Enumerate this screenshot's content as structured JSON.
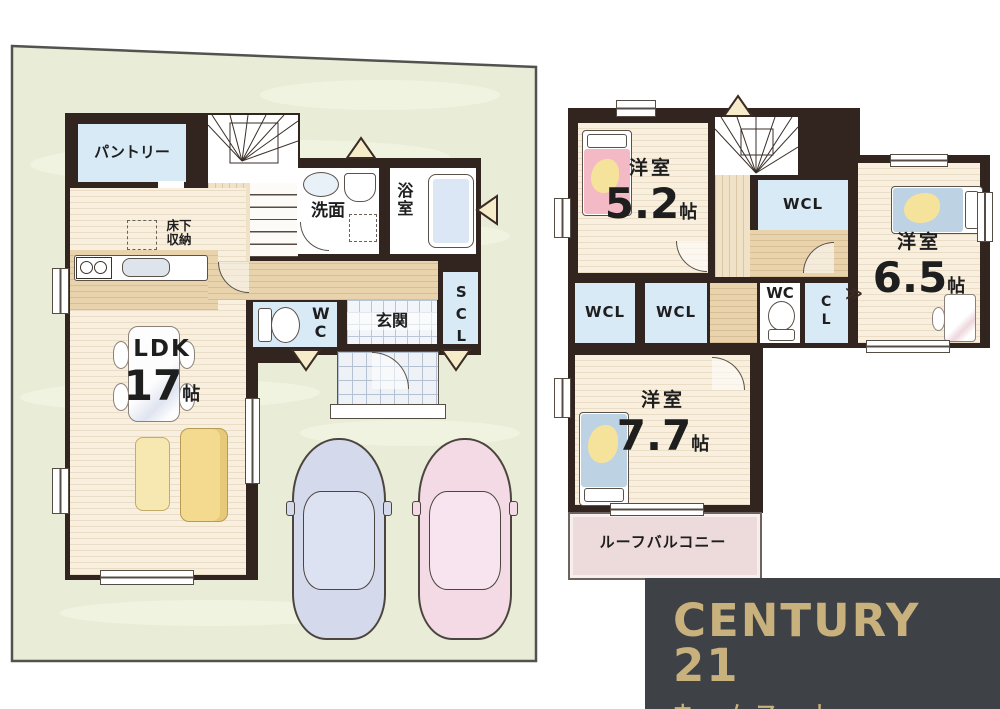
{
  "floor1": {
    "pantry": "パントリー",
    "washroom": "洗面",
    "bathroom": "浴室",
    "toilet": "WC",
    "entrance": "玄関",
    "shoe_closet": "SCL",
    "underfloor_storage_line1": "床下",
    "underfloor_storage_line2": "収納",
    "ldk": {
      "name": "LDK",
      "size": "17",
      "unit": "帖"
    }
  },
  "floor2": {
    "bedroom_5_2": {
      "name": "洋室",
      "size": "5.2",
      "unit": "帖"
    },
    "bedroom_6_5": {
      "name": "洋室",
      "size": "6.5",
      "unit": "帖"
    },
    "bedroom_7_7": {
      "name": "洋室",
      "size": "7.7",
      "unit": "帖"
    },
    "walk_in_closet": "WCL",
    "closet": "CL",
    "toilet": "WC",
    "roof_balcony": "ルーフバルコニー"
  },
  "logo": {
    "brand": "CENTURY 21",
    "shop_name": "ホームマート"
  },
  "colors": {
    "wall": "#32251f",
    "site_green": "#e9ecd7",
    "room_blue": "#d9eaf7",
    "floor_wood": "#f8efdf",
    "hall_wood": "#e8d3ad",
    "balcony_pink": "#eddbdb",
    "logo_bg": "#3e4145",
    "logo_gold": "#c9b17e",
    "car_blue": "#d4d9ec",
    "car_pink": "#f3dae5"
  }
}
